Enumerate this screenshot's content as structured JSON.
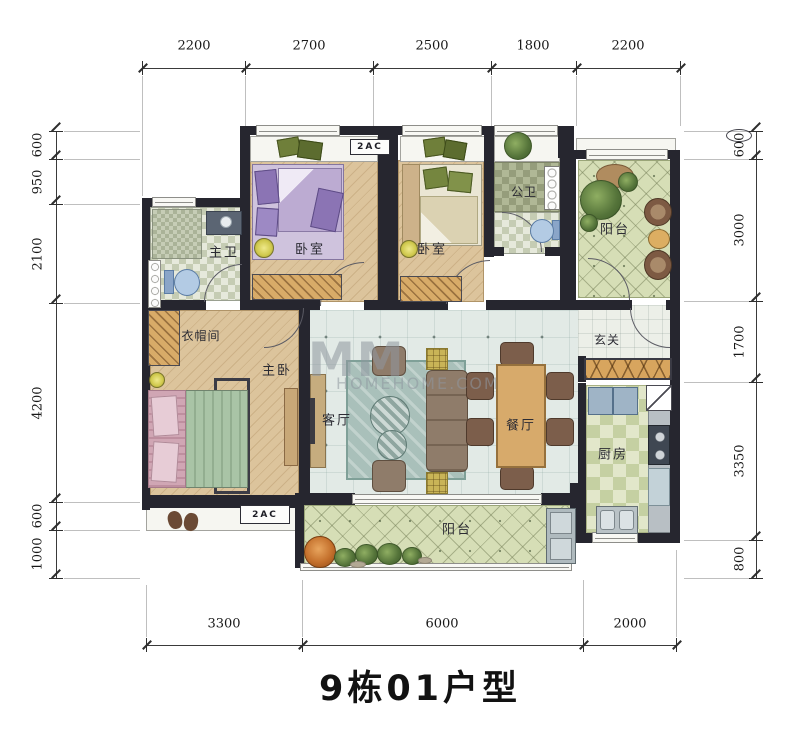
{
  "title": "9栋01户型",
  "watermark": {
    "mm": "MM",
    "site": "HOMEHOME.COM"
  },
  "ac_labels": {
    "top": "2AC",
    "bottom": "2AC"
  },
  "dims": {
    "top": [
      "2200",
      "2700",
      "2500",
      "1800",
      "2200"
    ],
    "left": [
      "600",
      "950",
      "2100",
      "4200",
      "600",
      "1000"
    ],
    "right": [
      "600",
      "3000",
      "1700",
      "3350",
      "800"
    ],
    "bottom": [
      "3300",
      "6000",
      "2000"
    ]
  },
  "rooms": {
    "master_bath": {
      "label": "主卫"
    },
    "bedroom_a": {
      "label": "卧室"
    },
    "bedroom_b": {
      "label": "卧室"
    },
    "guest_bath": {
      "label": "公卫"
    },
    "entry_balcony": {
      "label": "阳台"
    },
    "cloakroom": {
      "label": "衣帽间"
    },
    "master_bedroom": {
      "label": "主卧"
    },
    "living_room": {
      "label": "客厅"
    },
    "dining_room": {
      "label": "餐厅"
    },
    "foyer": {
      "label": "玄关"
    },
    "kitchen": {
      "label": "厨房"
    },
    "south_balcony": {
      "label": "阳台"
    }
  },
  "colors": {
    "wall": "#26262f",
    "wood_floor": "#dcc49c",
    "living_floor": "#e2eae6",
    "balcony_floor": "#d6deb6",
    "cabinet_wood": "#d8a55e",
    "dim_text": "#181818"
  }
}
